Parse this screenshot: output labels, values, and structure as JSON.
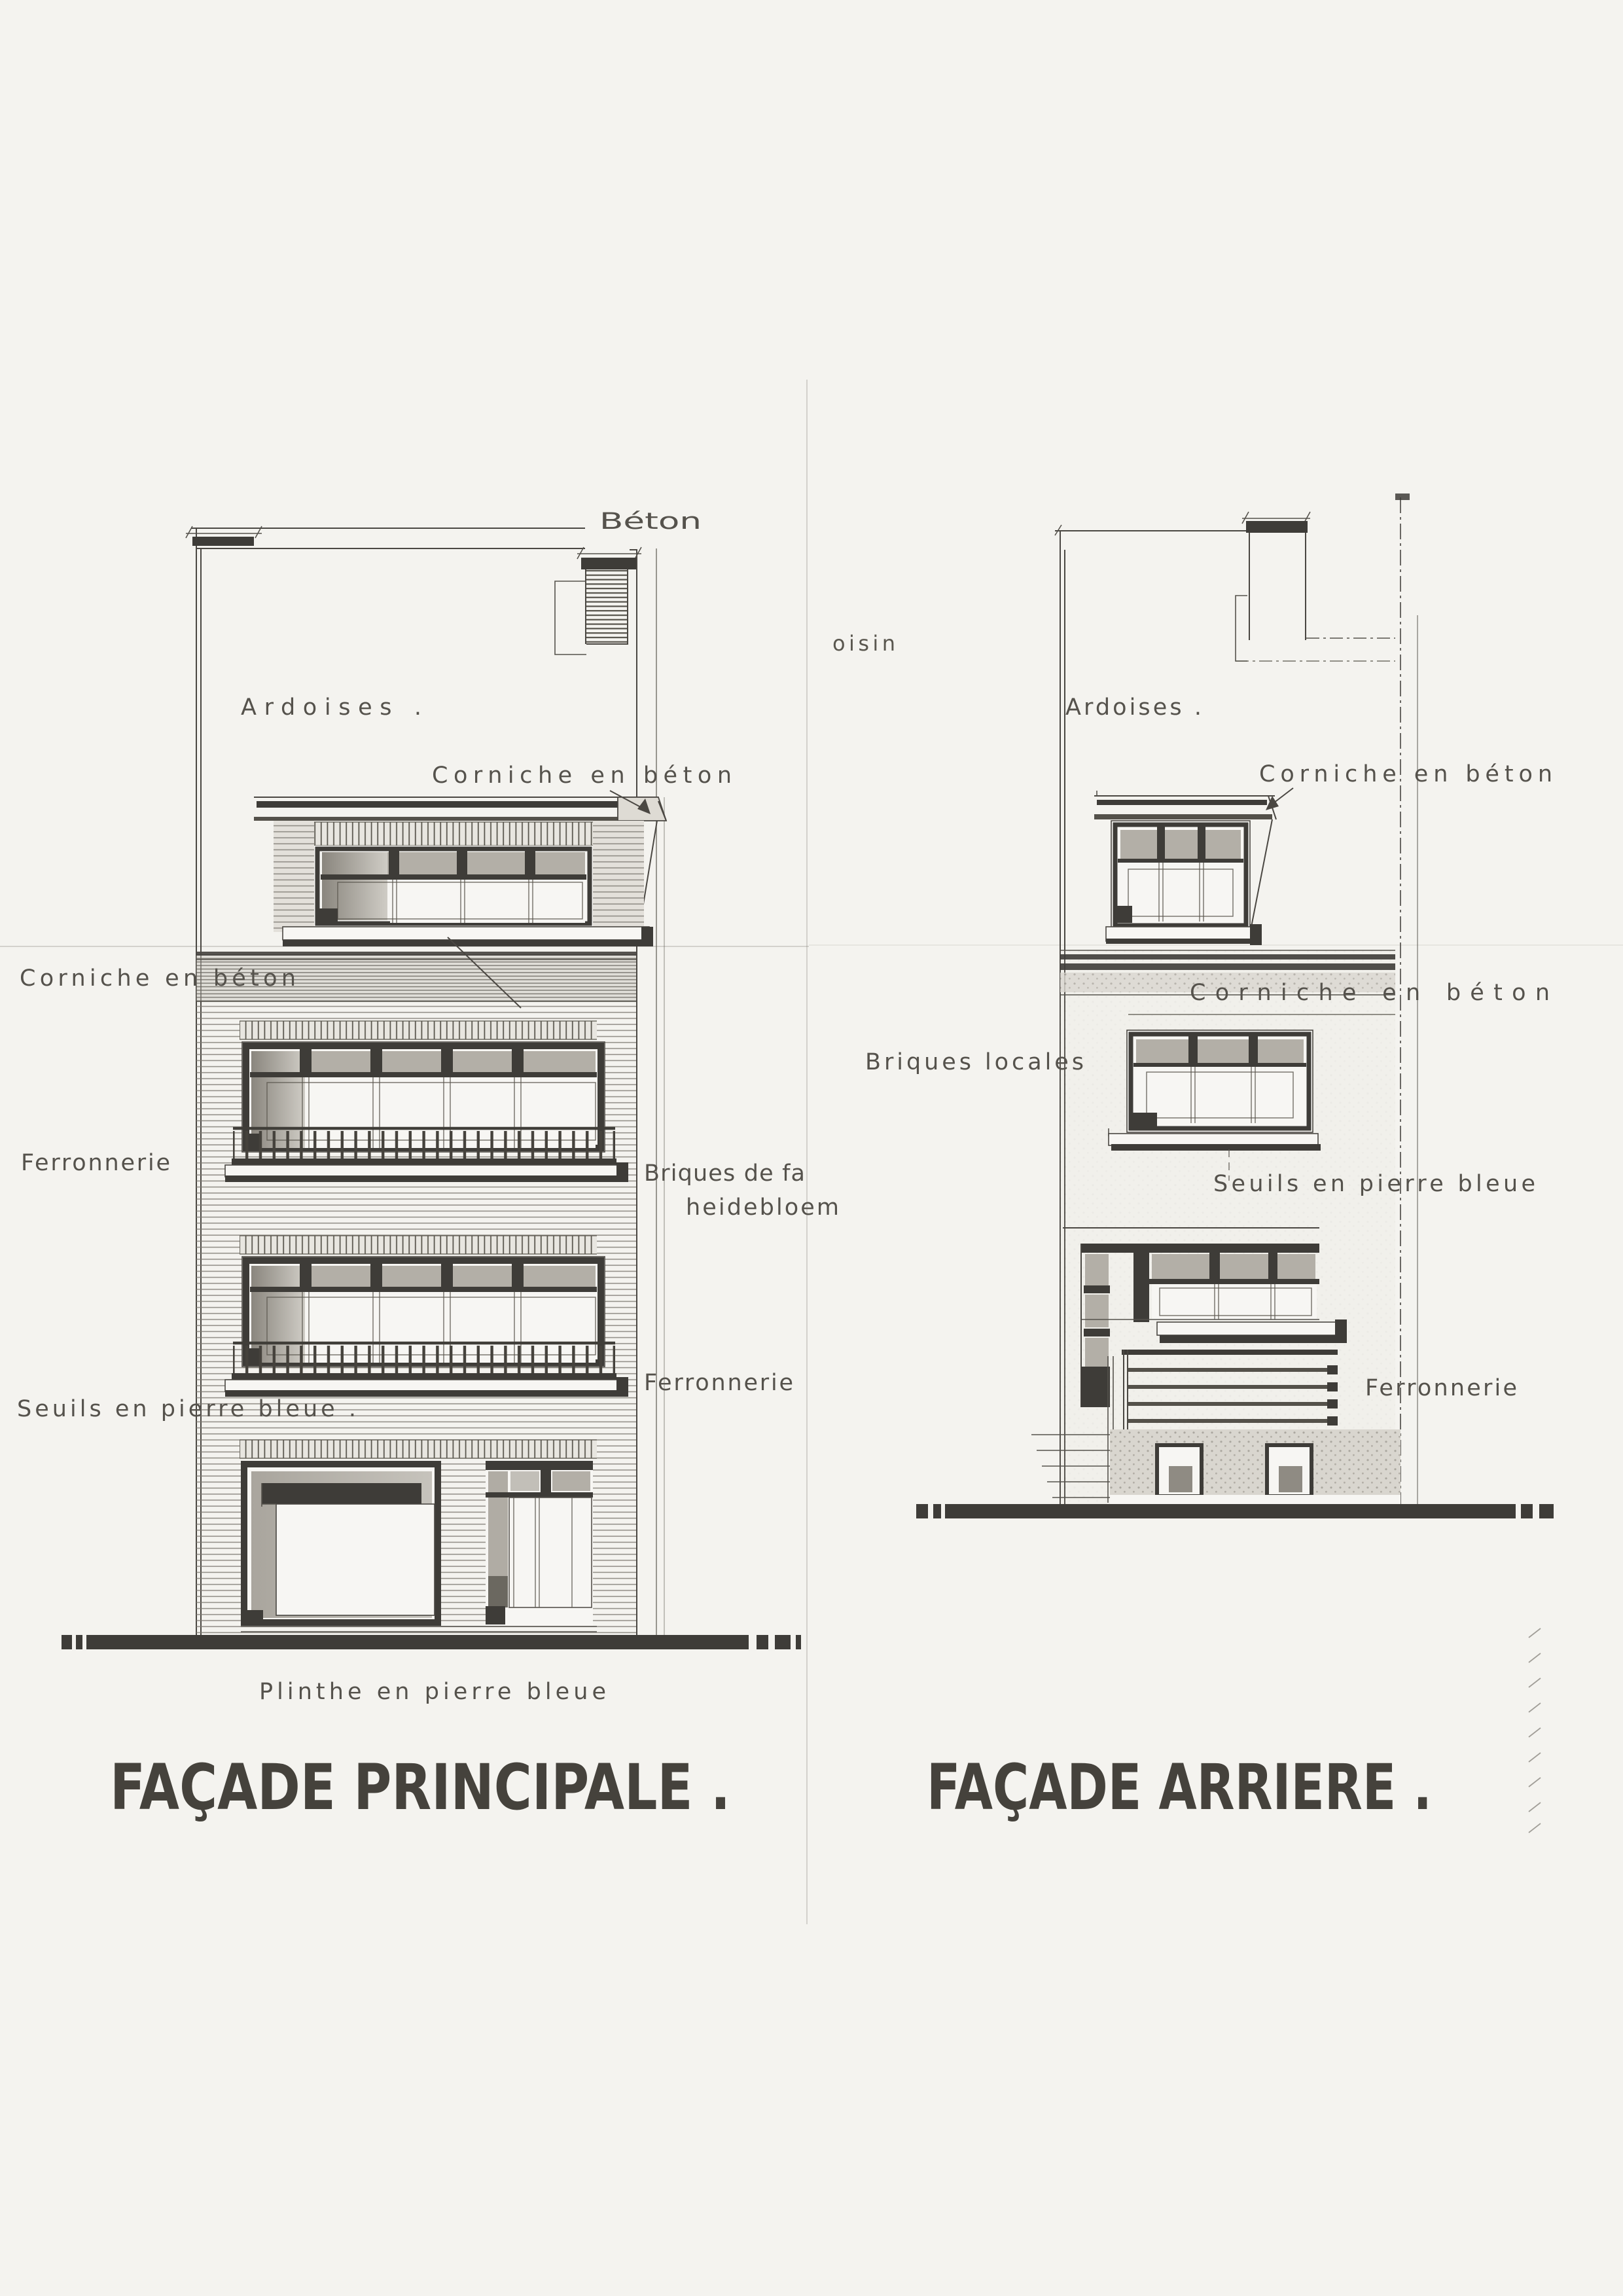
{
  "document": {
    "kind": "architectural elevation drawing (scan)",
    "colors": {
      "paper": "#f4f3ef",
      "ink": "#54514b",
      "dark": "#3e3c38",
      "shade": "#b3afa7"
    }
  },
  "left_elevation": {
    "title": "FAÇADE PRINCIPALE .",
    "labels": {
      "beton": "Béton",
      "ardoises": "Ardoises .",
      "corniche_top": "Corniche en béton",
      "corniche_side": "Corniche en béton",
      "ferronnerie_side": "Ferronnerie",
      "briques_line1": "Briques de fa",
      "briques_line2": "heidebloem",
      "ferronnerie_right": "Ferronnerie",
      "seuils": "Seuils en pierre bleue .",
      "plinthe": "Plinthe en pierre bleue"
    }
  },
  "right_elevation": {
    "title": "FAÇADE ARRIERE .",
    "labels": {
      "ardoises": "Ardoises .",
      "corniche_top": "Corniche en béton",
      "corniche_mid": "Corniche en béton",
      "briques_locales": "Briques locales",
      "seuils": "Seuils en pierre bleue",
      "ferronnerie": "Ferronnerie"
    }
  },
  "fragments": {
    "neighbour_text": "oisin"
  }
}
